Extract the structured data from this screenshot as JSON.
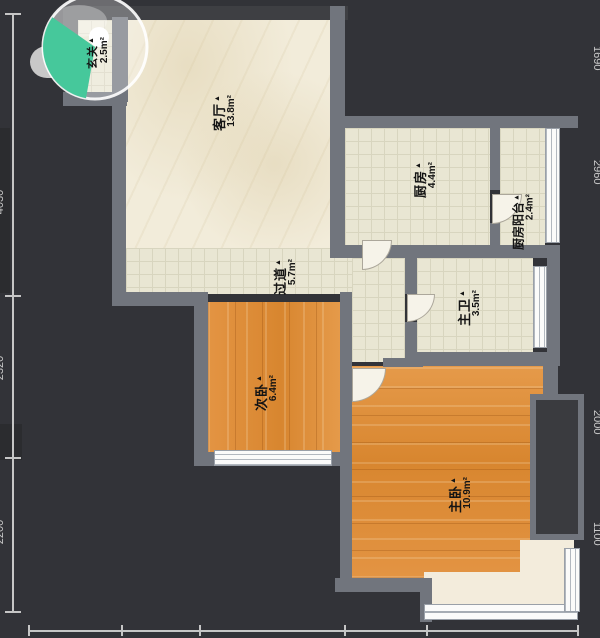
{
  "plan": {
    "marker": "▲",
    "rooms": [
      {
        "name": "玄关",
        "area": "2.5m²"
      },
      {
        "name": "客厅",
        "area": "13.8m²"
      },
      {
        "name": "厨房",
        "area": "4.4m²"
      },
      {
        "name": "厨房阳台",
        "area": "2.4m²"
      },
      {
        "name": "过道",
        "area": "5.7m²"
      },
      {
        "name": "主卫",
        "area": "3.5m²"
      },
      {
        "name": "次卧",
        "area": "6.4m²"
      },
      {
        "name": "主卧",
        "area": "10.9m²"
      }
    ],
    "colors": {
      "background": "#323338",
      "wall": "#71757d",
      "wall_dark": "#3e3f43",
      "wood_floor": "#e0923f",
      "tile_floor": "#e9e6d3",
      "marble_floor": "#f2ecda",
      "compass_wedge": "#46c89b",
      "dimension": "#c9c9c9"
    },
    "edge_dimensions": {
      "right": [
        "1690",
        "2960",
        "2000",
        "1100"
      ],
      "left": [
        "4030",
        "2320",
        "2200"
      ]
    }
  }
}
